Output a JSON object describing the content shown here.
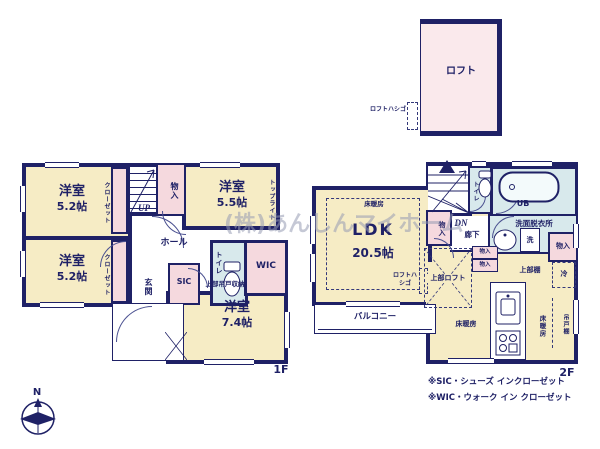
{
  "watermark": "(株)あんしんマイホーム",
  "compass": {
    "north": "N"
  },
  "loft": {
    "room": "ロフト",
    "ladder": "ロフトハシゴ"
  },
  "floor1": {
    "floor_label": "1F",
    "bedroom_a": {
      "name": "洋室",
      "size": "5.2帖"
    },
    "bedroom_b": {
      "name": "洋室",
      "size": "5.2帖"
    },
    "bedroom_c": {
      "name": "洋室",
      "size": "5.5帖"
    },
    "bedroom_d": {
      "name": "洋室",
      "size": "7.4帖"
    },
    "closet": "クローゼット",
    "storage": "物入",
    "hall": "ホール",
    "entrance": "玄関",
    "sic": "SIC",
    "wic": "WIC",
    "toilet": "トイレ",
    "toplight": "トップライト",
    "upper_hanging_storage": "上部吊戸収納",
    "up": "UP"
  },
  "floor2": {
    "floor_label": "2F",
    "ldk": {
      "name": "LDK",
      "size": "20.5帖"
    },
    "floor_heating": "床暖房",
    "storage": "物入",
    "corridor": "廊下",
    "toilet": "トイレ",
    "bath": "UB",
    "washroom": "洗面脱衣所",
    "washer": "洗",
    "upper_shelf": "上部棚",
    "fridge": "冷",
    "upper_loft": "上部ロフト",
    "loft_ladder": "ロフトハシゴ",
    "balcony": "バルコニー",
    "hanging_cupboard": "吊戸棚",
    "dn": "DN"
  },
  "notes": {
    "sic": "※SIC・シューズ インクローゼット",
    "wic": "※WIC・ウォーク イン クローゼット"
  },
  "colors": {
    "wall": "#1f2166",
    "room_floor": "#f6ecc5",
    "closet_pink": "#f5d9de",
    "wet_blue": "#d8e9ec",
    "loft_pink": "#fae9ec",
    "watermark_gray": "#969bb2"
  }
}
